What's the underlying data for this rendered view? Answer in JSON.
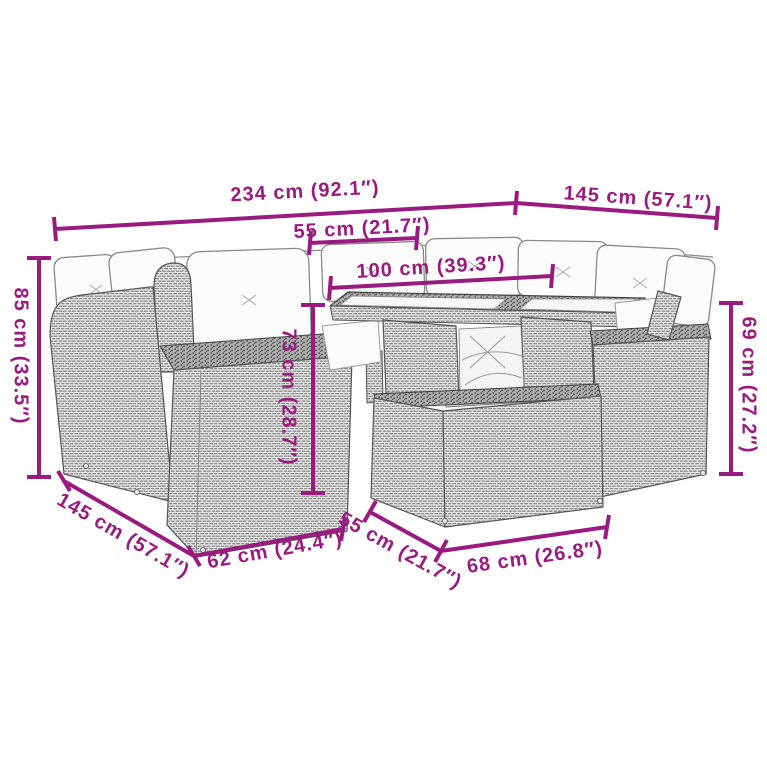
{
  "colors": {
    "dimension_accent": "#9A1B80",
    "drawing_outline": "#555555",
    "rattan_fill": "#e6e6e6",
    "cushion_fill": "#fcfcfc"
  },
  "illustration": {
    "subject": "rattan-garden-lounge-set-line-drawing"
  },
  "dimensions": {
    "overall_width": "234 cm (92.1″)",
    "right_wing_depth": "145 cm (57.1″)",
    "seat_module_width": "55 cm (21.7″)",
    "table_length": "100 cm (39.3″)",
    "back_height": "85 cm (33.5″)",
    "table_height": "73 cm (28.7″)",
    "right_seat_height": "69 cm (27.2″)",
    "left_wing_depth": "145 cm (57.1″)",
    "front_seat_width": "62 cm (24.4″)",
    "ottoman_depth": "55 cm (21.7″)",
    "ottoman_width": "68 cm (26.8″)"
  }
}
